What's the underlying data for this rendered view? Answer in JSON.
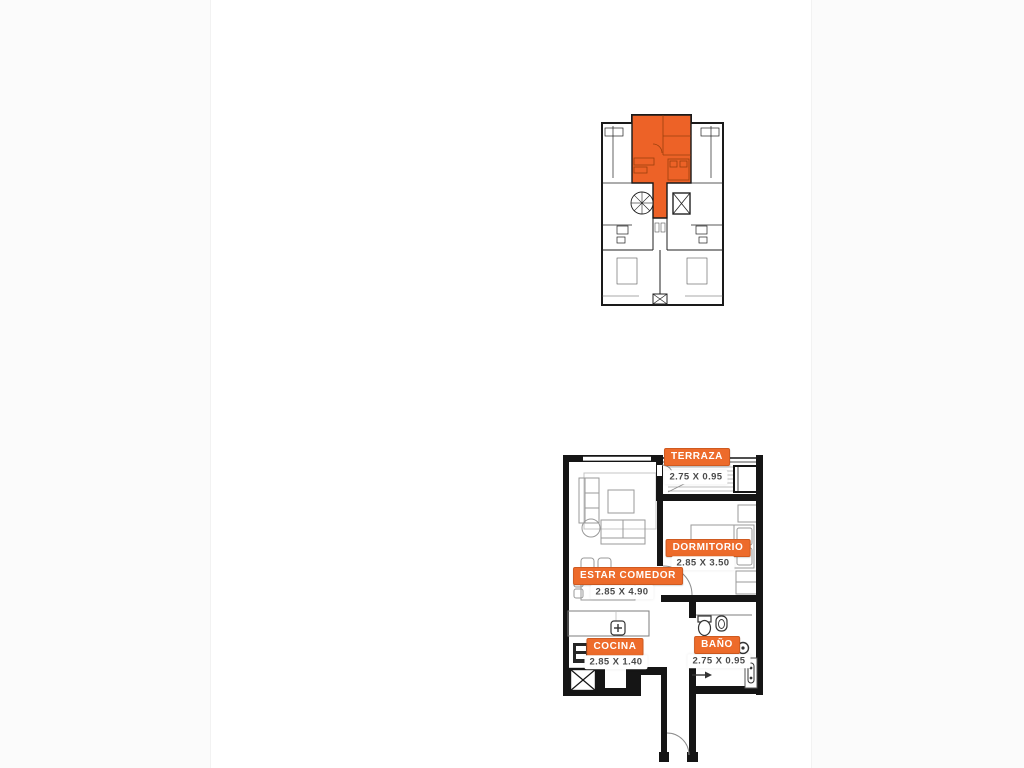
{
  "colors": {
    "highlight_orange": "#ED6227",
    "badge_orange": "#ED6B2B",
    "wall_black": "#151515",
    "furniture_gray": "#8a8a8a"
  },
  "key_plan": {
    "name": "building key plan with highlighted unit"
  },
  "floor_plan": {
    "rooms": [
      {
        "name": "TERRAZA",
        "dimensions": "2.75 X 0.95"
      },
      {
        "name": "DORMITORIO",
        "dimensions": "2.85 X 3.50"
      },
      {
        "name": "ESTAR COMEDOR",
        "dimensions": "2.85 X 4.90"
      },
      {
        "name": "COCINA",
        "dimensions": "2.85 X 1.40"
      },
      {
        "name": "BAÑO",
        "dimensions": "2.75 X 0.95"
      }
    ]
  }
}
